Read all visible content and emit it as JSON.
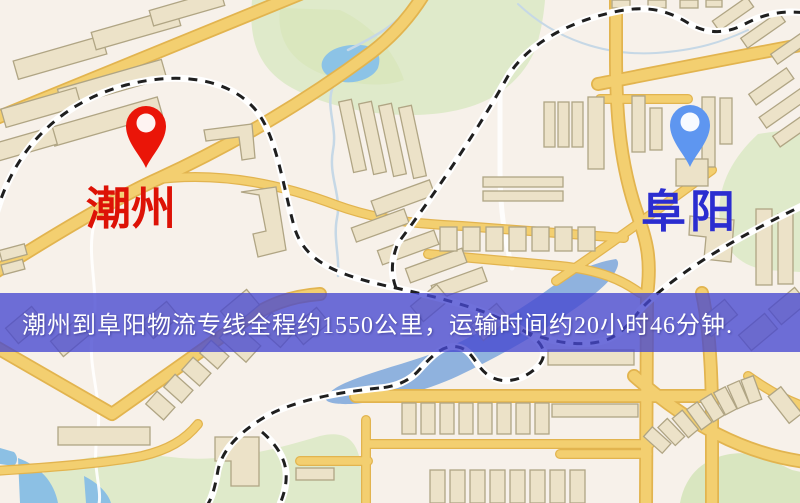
{
  "map": {
    "origin": {
      "name": "潮州",
      "pin_color": "#ea1508",
      "label_color": "#dd1206"
    },
    "destination": {
      "name": "阜阳",
      "pin_color": "#5e96f0",
      "label_color": "#2b2dd0"
    },
    "banner": {
      "text": "潮州到阜阳物流专线全程约1550公里，运输时间约20小时46分钟.",
      "background_color": "rgba(70,72,208,0.78)",
      "text_color": "#ffffff",
      "distance_km": "1550",
      "duration_hours": "20",
      "duration_minutes": "46"
    },
    "palette": {
      "background": "#f7f1ea",
      "road": "#f3cf70",
      "road_casing": "#e2b44f",
      "building": "#ece2c8",
      "building_outline": "#b0a584",
      "park": "#dfeaca",
      "water": "#8fb2de",
      "railway": "#1f1f1f"
    }
  }
}
